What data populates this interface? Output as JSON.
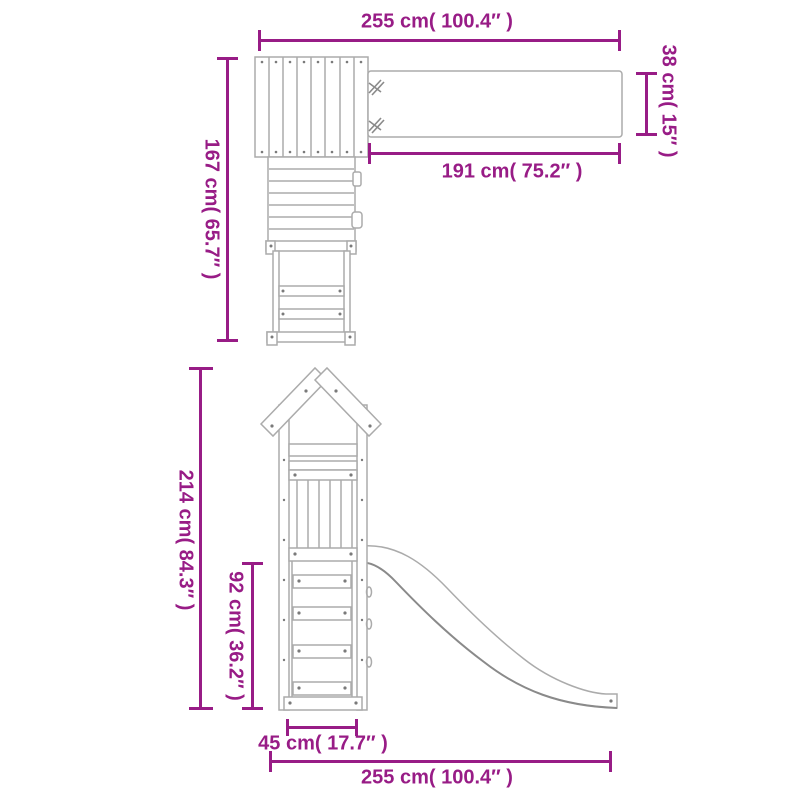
{
  "colors": {
    "accent": "#981C86",
    "line": "#ABABAB",
    "line_dark": "#8A8A8A",
    "bolt": "#7A7A7A"
  },
  "plan_view": {
    "description": "wooden playhouse with swing beam seen from above",
    "total_width": "255 cm( 100.4″ )",
    "beam_depth": "38 cm( 15″ )",
    "beam_length": "191 cm( 75.2″ )",
    "total_depth": "167 cm( 65.7″ )"
  },
  "front_view": {
    "description": "playhouse tower with slide seen from the front",
    "total_height": "214 cm( 84.3″ )",
    "platform_height": "92 cm( 36.2″ )",
    "ladder_width": "45 cm( 17.7″ )",
    "total_width": "255 cm( 100.4″ )"
  }
}
